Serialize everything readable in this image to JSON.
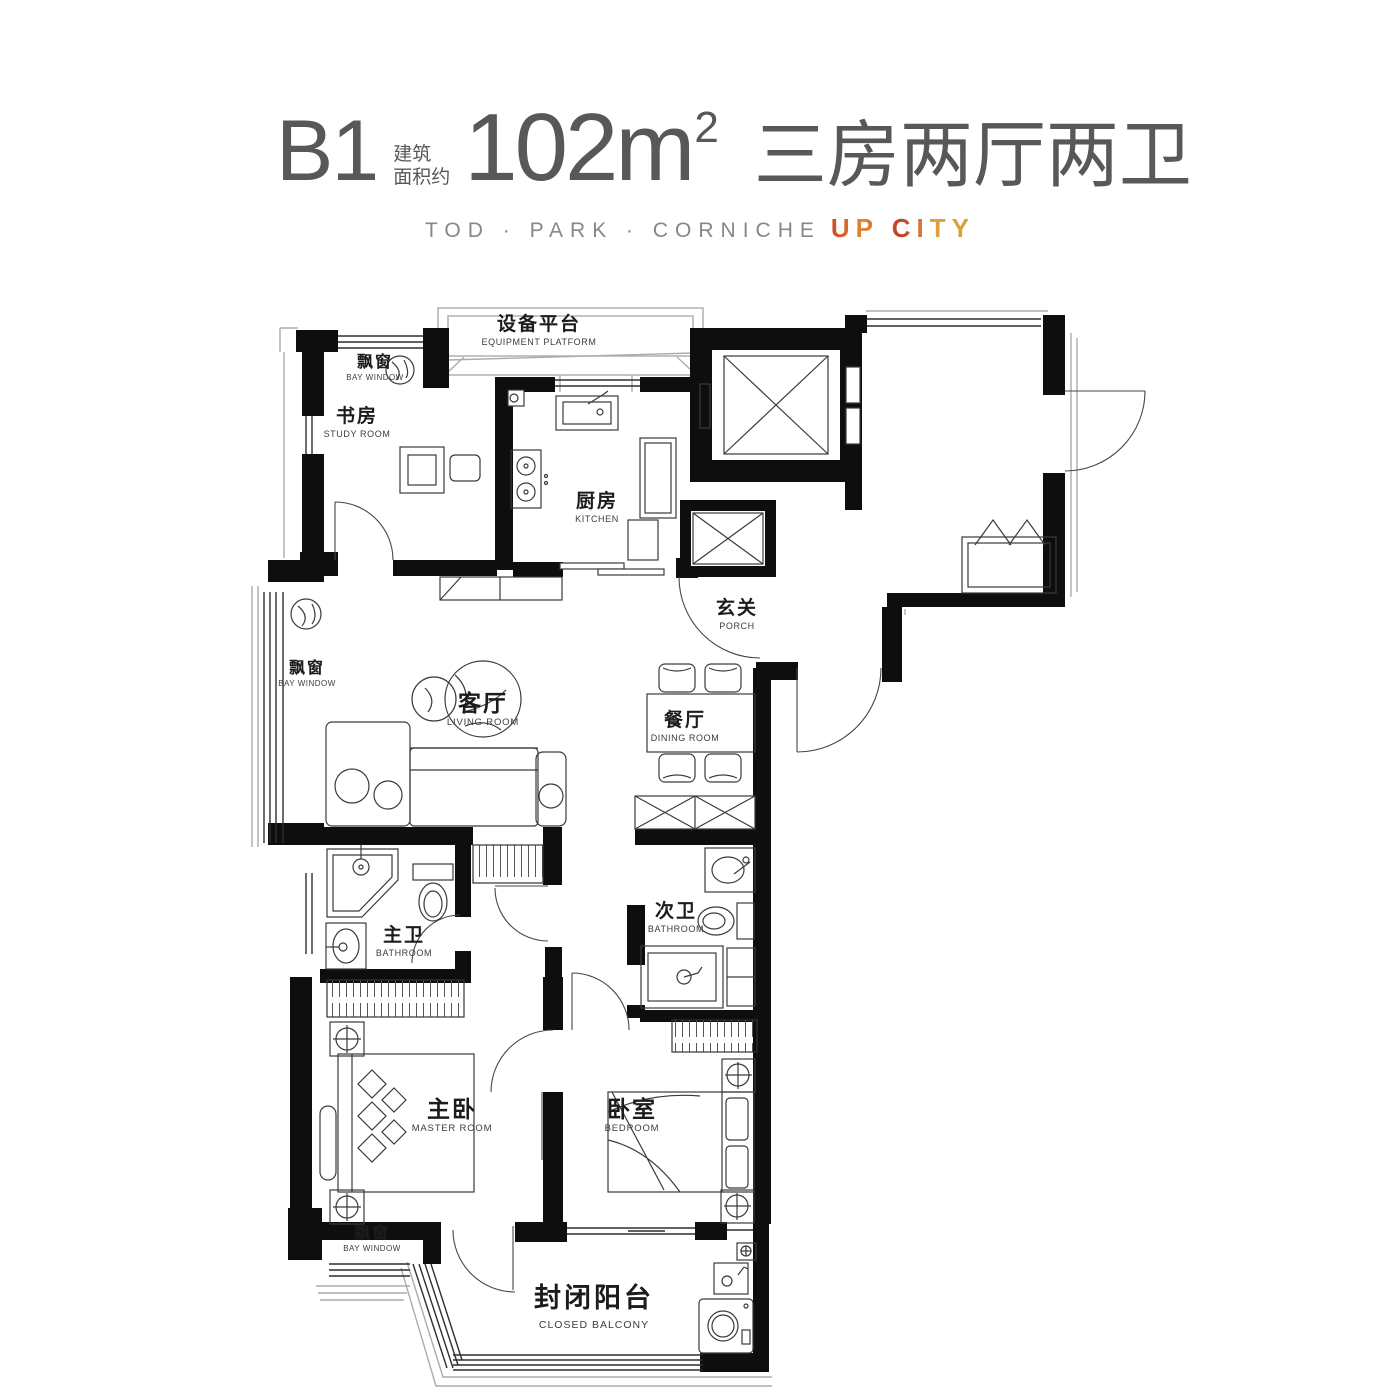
{
  "header": {
    "unit_code": "B1",
    "area_label_line1": "建筑",
    "area_label_line2": "面积约",
    "area_value": "102m",
    "area_superscript": "2",
    "layout_text": "三房两厅两卫",
    "brand_line": "TOD · PARK · CORNICHE",
    "brand_highlight": "UP CITY"
  },
  "rooms": {
    "equipment_platform": {
      "zh": "设备平台",
      "en": "EQUIPMENT PLATFORM"
    },
    "bay_window_top": {
      "zh": "飘窗",
      "en": "BAY WINDOW"
    },
    "study": {
      "zh": "书房",
      "en": "STUDY ROOM"
    },
    "kitchen": {
      "zh": "厨房",
      "en": "KITCHEN"
    },
    "porch": {
      "zh": "玄关",
      "en": "PORCH"
    },
    "bay_window_left": {
      "zh": "飘窗",
      "en": "BAY WINDOW"
    },
    "living": {
      "zh": "客厅",
      "en": "LIVING ROOM"
    },
    "dining": {
      "zh": "餐厅",
      "en": "DINING ROOM"
    },
    "master_bath": {
      "zh": "主卫",
      "en": "BATHROOM"
    },
    "second_bath": {
      "zh": "次卫",
      "en": "BATHROOM"
    },
    "master_bedroom": {
      "zh": "主卧",
      "en": "MASTER ROOM"
    },
    "bedroom": {
      "zh": "卧室",
      "en": "BEDROOM"
    },
    "bay_window_bottom": {
      "zh": "飘窗",
      "en": "BAY WINDOW"
    },
    "closed_balcony": {
      "zh": "封闭阳台",
      "en": "CLOSED BALCONY"
    }
  },
  "colors": {
    "wall": "#0e0e0e",
    "title_text": "#57585a",
    "subtitle_text": "#85878a",
    "accent_warm": "#cf6a28"
  }
}
